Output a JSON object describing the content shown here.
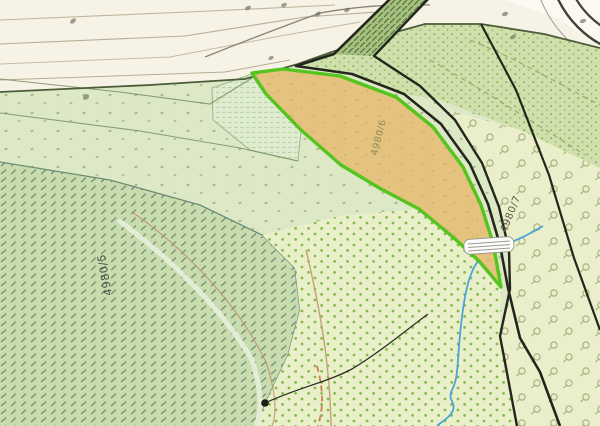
{
  "map": {
    "type": "cadastral-topographic-map-3d-tilt",
    "parcel_labels": [
      {
        "id": "left-parcel",
        "text": "4980/5"
      },
      {
        "id": "selected-parcel",
        "text": "4980/6"
      },
      {
        "id": "right-parcel",
        "text": "4980/7"
      }
    ],
    "selected_parcel": {
      "label": "4980/6",
      "fill_color": "#e5c37e",
      "outline_color": "#55c41f"
    },
    "colors": {
      "road_area": "#f6f2e5",
      "grass_light": "#dde8c6",
      "grass_dense_dots": "#cfe0ab",
      "forest_hatch_bg": "#c9dcae",
      "meadow_dot_bg": "#e9f0c9",
      "orchard_bg": "#ebeecb",
      "boundary_black": "#23261b",
      "selection_green": "#55c41f",
      "stream_blue": "#4aa4d8",
      "contour_brown": "#c4a173",
      "road_edge_dark": "#4c5c38"
    },
    "symbols": [
      "forest-hatch-pattern",
      "meadow-dot-grid-pattern",
      "orchard-tree-symbols",
      "grass-speck-pattern",
      "bridge-symbol",
      "stream-line",
      "spot-point-with-leader",
      "road-curve-arcs",
      "tiny-illegible-labels"
    ]
  }
}
